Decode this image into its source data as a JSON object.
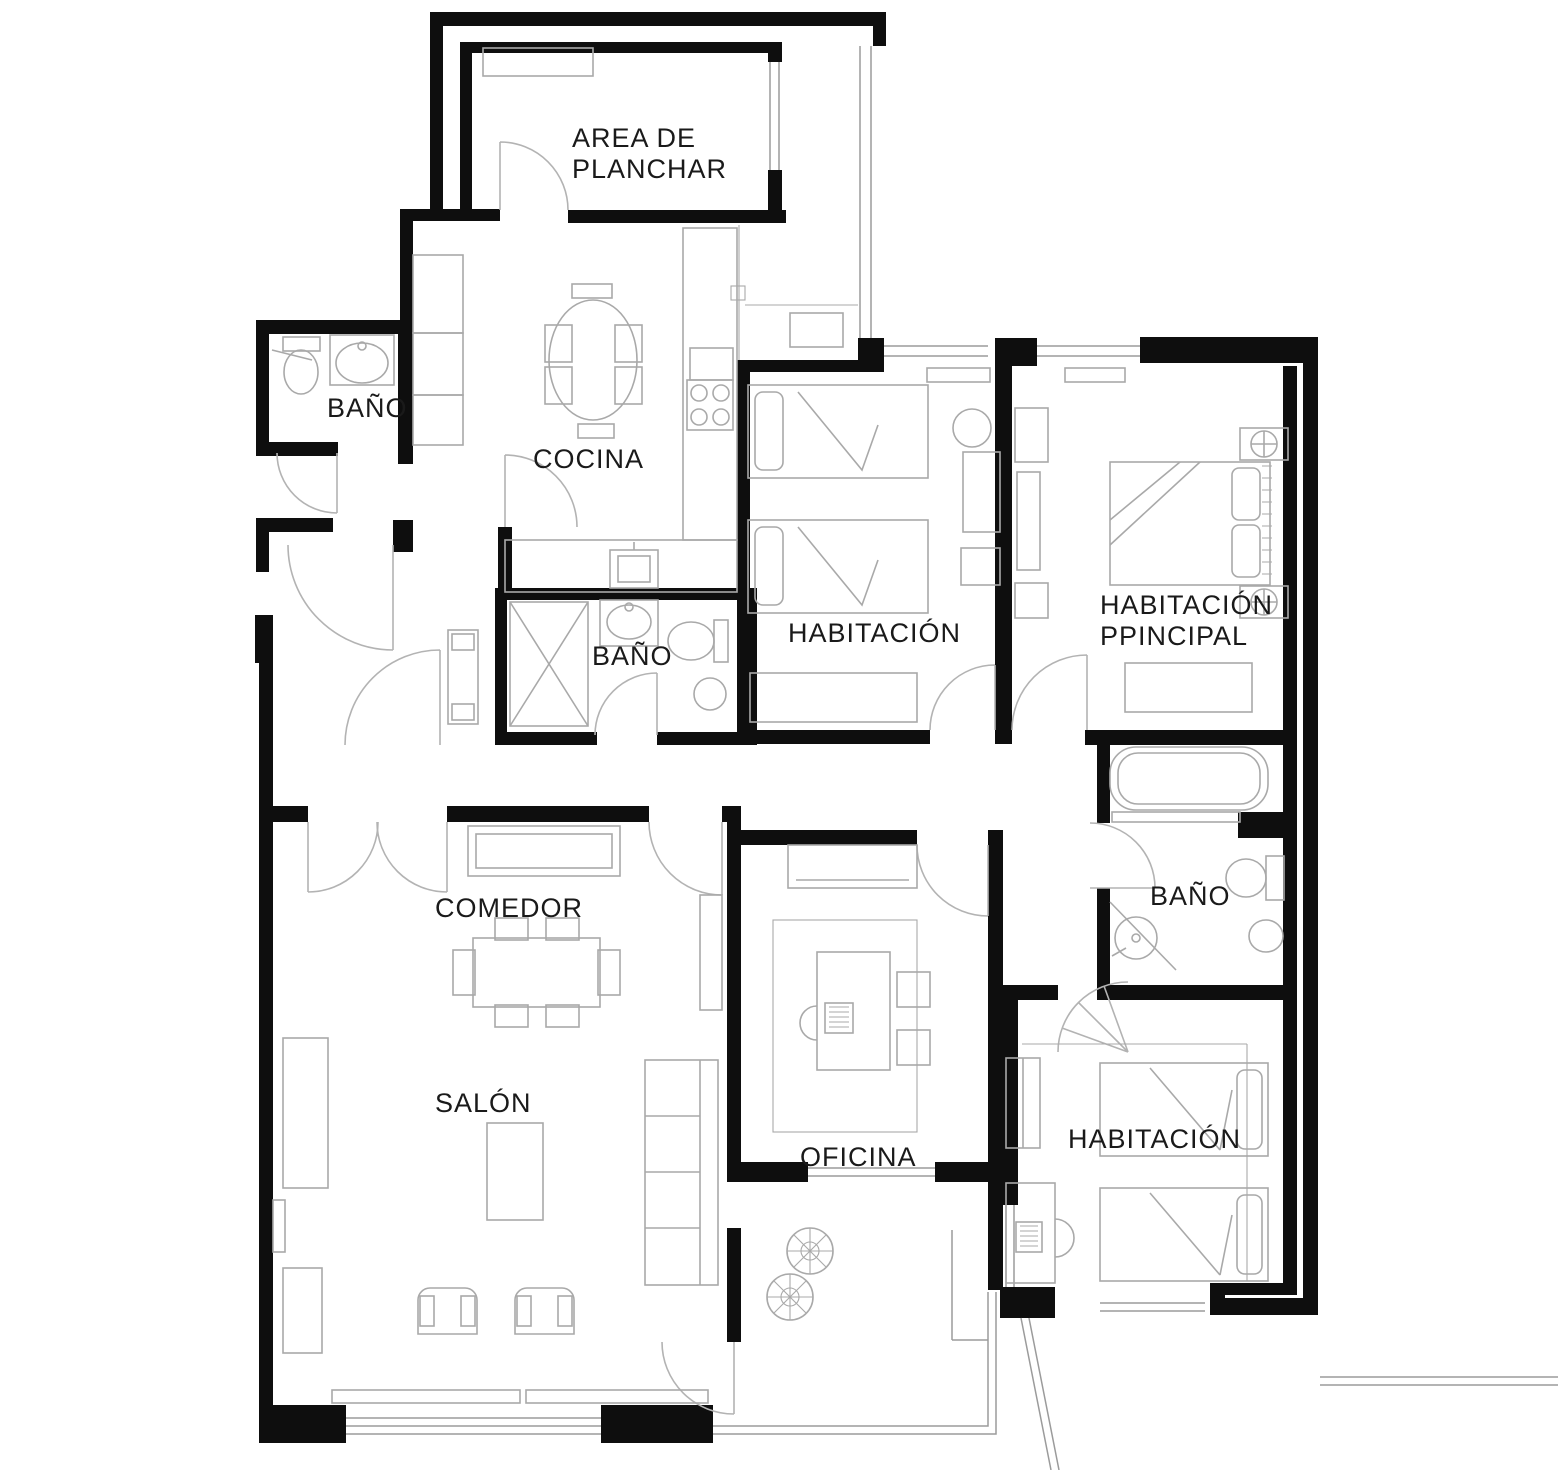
{
  "title": "Plano de apartamento",
  "colors": {
    "bg": "#ffffff",
    "wall": "#0e0e0e",
    "furn": "#a9a9a9",
    "door": "#b3b3b3",
    "win": "#9b9b9b",
    "text": "#1a1a1a"
  },
  "rooms": {
    "laundry": {
      "label_line1": "AREA DE",
      "label_line2": "PLANCHAR"
    },
    "bath_top_left": {
      "label": "BAÑO"
    },
    "kitchen": {
      "label": "COCINA"
    },
    "bath_middle": {
      "label": "BAÑO"
    },
    "bedroom_center": {
      "label": "HABITACIÓN"
    },
    "bedroom_main": {
      "label_line1": "HABITACIÓN",
      "label_line2": "PPINCIPAL"
    },
    "dining": {
      "label": "COMEDOR"
    },
    "bath_right": {
      "label": "BAÑO"
    },
    "living": {
      "label": "SALÓN"
    },
    "office": {
      "label": "OFICINA"
    },
    "bedroom_bottom": {
      "label": "HABITACIÓN"
    }
  }
}
